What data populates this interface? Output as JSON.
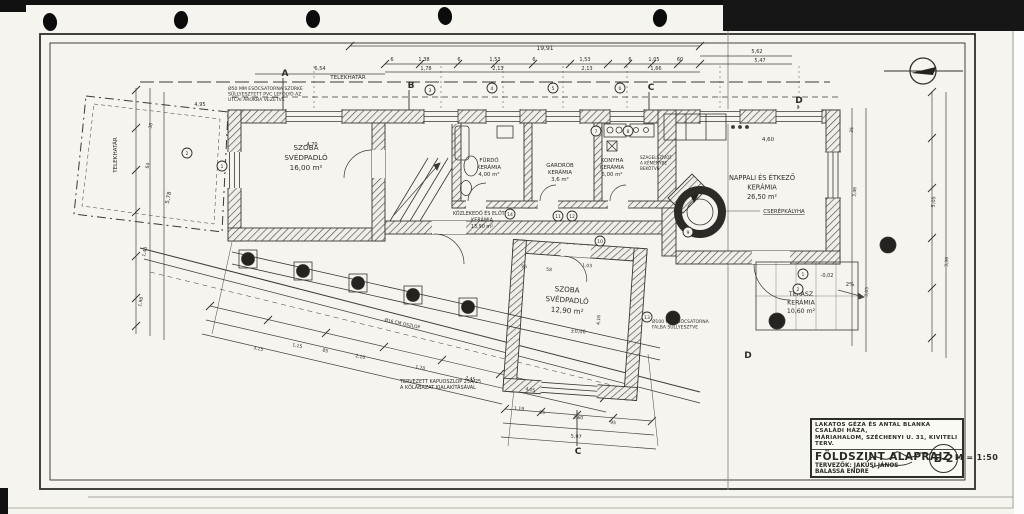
{
  "title_block": {
    "project_line1": "LAKATOS GÉZA ÉS ANTAL BLANKA CSALÁDI HÁZA,",
    "project_line2": "MÁRIAHALOM, SZÉCHENYI U. 31, KIVITELI TERV.",
    "drawing_title": "FÖLDSZINT ALAPRAJZ",
    "scale": "M = 1:50",
    "designers_label": "TERVEZŐK:",
    "designer_1": "JAKUSI JÁNOS",
    "designer_2": "BALASSA ENDRE",
    "sheet_code": "E-2"
  },
  "plan": {
    "rooms": [
      {
        "label": [
          "SZOBA",
          "SVÉDPADLÓ",
          "16,00 m²"
        ],
        "x": 306,
        "y": 150,
        "s": 7.2,
        "lh": 10,
        "r": 0
      },
      {
        "label": [
          "FÜRDŐ",
          "KERÁMIA",
          "4,00 m²"
        ],
        "x": 489,
        "y": 162,
        "s": 5.4,
        "lh": 7,
        "r": 0
      },
      {
        "label": [
          "GARDRÓB",
          "KERÁMIA",
          "3,6 m²"
        ],
        "x": 560,
        "y": 167,
        "s": 5.4,
        "lh": 7,
        "r": 0
      },
      {
        "label": [
          "KONYHA",
          "KERÁMIA",
          "6,00 m²"
        ],
        "x": 612,
        "y": 162,
        "s": 5.4,
        "lh": 7,
        "r": 0
      },
      {
        "label": [
          "NAPPALI ÉS ÉTKEZŐ",
          "KERÁMIA",
          "26,50 m²"
        ],
        "x": 762,
        "y": 180,
        "s": 6.6,
        "lh": 9.5,
        "r": 0
      },
      {
        "label": [
          "KÖZLEKEDŐ ÉS ELŐTÉR",
          "KERÁMIA",
          "13,90 m²"
        ],
        "x": 482,
        "y": 215,
        "s": 4.9,
        "lh": 6.4,
        "r": 0
      },
      {
        "label": [
          "SZOBA",
          "SVÉDPADLÓ",
          "12,90 m²"
        ],
        "x": 567,
        "y": 292,
        "s": 7.2,
        "lh": 10.5,
        "r": 4
      },
      {
        "label": [
          "TERASZ",
          "KERÁMIA",
          "10,60 m²"
        ],
        "x": 801,
        "y": 296,
        "s": 6.2,
        "lh": 8.5,
        "r": 0
      }
    ],
    "notes": [
      {
        "lines": [
          "Ø50 MM ESŐCSATORNA SZÜRKE",
          "SÜLLYESZTETT PVC LEFOLYÓ AZ",
          "UTCAI ÁROKBA VEZETVE"
        ],
        "x": 228,
        "y": 90,
        "s": 4.6,
        "lh": 5.6
      },
      {
        "lines": [
          "SZAGELSZÍVÓT",
          "A KÉMÉNYBE",
          "BEKÖTVE"
        ],
        "x": 640,
        "y": 159,
        "s": 4.2,
        "lh": 5.4
      },
      {
        "lines": [
          "TERVEZETT KAPUOSZLOP 25Á/25",
          "A KŐLÁBAZAT KIALAKÍTÁSÁVAL"
        ],
        "x": 400,
        "y": 383,
        "s": 4.9,
        "lh": 6
      },
      {
        "lines": [
          "Ø100 MM ESŐCSATORNA",
          "FALBA SÜLLYESZTVE"
        ],
        "x": 652,
        "y": 323,
        "s": 4.5,
        "lh": 5.6
      }
    ],
    "texts": [
      {
        "t": "TELEKHATÁR",
        "x": 348,
        "y": 79,
        "s": 5.6
      },
      {
        "t": "TELEKHATÁR",
        "x": 117,
        "y": 155,
        "s": 5.6,
        "r": -90
      },
      {
        "t": "CSERÉPKÁLYHA",
        "x": 784,
        "y": 213,
        "s": 5.4,
        "u": 1
      },
      {
        "t": "Ø16 CM OSZLOP",
        "x": 402,
        "y": 325,
        "s": 4.4,
        "r": 12
      },
      {
        "t": "2%",
        "x": 850,
        "y": 286,
        "s": 5.6
      },
      {
        "t": "-0,02",
        "x": 827,
        "y": 277,
        "s": 5
      },
      {
        "t": "±0,00",
        "x": 578,
        "y": 333,
        "s": 5,
        "r": 4
      }
    ],
    "dims": [
      {
        "t": "19,91",
        "x": 545,
        "y": 50,
        "s": 6
      },
      {
        "t": "6",
        "x": 392,
        "y": 61
      },
      {
        "t": "1,38",
        "x": 424,
        "y": 61
      },
      {
        "t": "1,78",
        "x": 426,
        "y": 70
      },
      {
        "t": "6",
        "x": 459,
        "y": 61
      },
      {
        "t": "1,53",
        "x": 495,
        "y": 61
      },
      {
        "t": "2,13",
        "x": 498,
        "y": 70
      },
      {
        "t": "6",
        "x": 534,
        "y": 61
      },
      {
        "t": "1,53",
        "x": 585,
        "y": 61
      },
      {
        "t": "2,13",
        "x": 587,
        "y": 70
      },
      {
        "t": "6",
        "x": 630,
        "y": 61
      },
      {
        "t": "1,05",
        "x": 654,
        "y": 61
      },
      {
        "t": "1,66",
        "x": 656,
        "y": 70
      },
      {
        "t": "60",
        "x": 680,
        "y": 61
      },
      {
        "t": "5,62",
        "x": 757,
        "y": 53
      },
      {
        "t": "5,47",
        "x": 760,
        "y": 62
      },
      {
        "t": "6,54",
        "x": 320,
        "y": 70
      },
      {
        "t": "4,95",
        "x": 200,
        "y": 106
      },
      {
        "t": "4,70",
        "x": 312,
        "y": 146
      },
      {
        "t": "4,60",
        "x": 768,
        "y": 141,
        "s": 5.5
      },
      {
        "t": "96",
        "x": 524,
        "y": 268,
        "r": 4,
        "s": 4.5
      },
      {
        "t": "58",
        "x": 549,
        "y": 271,
        "r": 4,
        "s": 4.5
      },
      {
        "t": "1,03",
        "x": 587,
        "y": 267,
        "r": 4,
        "s": 4.5
      },
      {
        "t": "4,16",
        "x": 600,
        "y": 320,
        "r": -86,
        "s": 4.5
      },
      {
        "t": "1,19",
        "x": 519,
        "y": 410,
        "r": 5,
        "s": 4.5
      },
      {
        "t": "95",
        "x": 542,
        "y": 414,
        "r": 5,
        "s": 4.5
      },
      {
        "t": "3,60",
        "x": 578,
        "y": 419,
        "r": 5,
        "s": 4.5
      },
      {
        "t": "95",
        "x": 613,
        "y": 424,
        "r": 5,
        "s": 4.5
      },
      {
        "t": "5,97",
        "x": 576,
        "y": 438,
        "r": 5,
        "s": 5
      },
      {
        "t": "3,15",
        "x": 258,
        "y": 350,
        "r": 12,
        "s": 4.5
      },
      {
        "t": "1,15",
        "x": 297,
        "y": 347,
        "r": 12,
        "s": 4.5
      },
      {
        "t": "85",
        "x": 325,
        "y": 352,
        "r": 12,
        "s": 4.5
      },
      {
        "t": "2,10",
        "x": 360,
        "y": 358,
        "r": 12,
        "s": 4.5
      },
      {
        "t": "1,70",
        "x": 420,
        "y": 369,
        "r": 12,
        "s": 4.5
      },
      {
        "t": "2,45",
        "x": 470,
        "y": 380,
        "r": 12,
        "s": 4.5
      },
      {
        "t": "4,05",
        "x": 530,
        "y": 391,
        "r": 12,
        "s": 4.5
      },
      {
        "t": "30",
        "x": 152,
        "y": 126,
        "r": -78,
        "s": 4.5
      },
      {
        "t": "64",
        "x": 149,
        "y": 166,
        "r": -78,
        "s": 4.5
      },
      {
        "t": "5,78",
        "x": 170,
        "y": 198,
        "r": -78,
        "s": 5.5
      },
      {
        "t": "1,40",
        "x": 146,
        "y": 252,
        "r": -78,
        "s": 4.5
      },
      {
        "t": "1,90",
        "x": 142,
        "y": 302,
        "r": -78,
        "s": 4.5
      },
      {
        "t": "35",
        "x": 853,
        "y": 130,
        "r": -86,
        "s": 4.5
      },
      {
        "t": "3,46",
        "x": 856,
        "y": 192,
        "r": -86,
        "s": 4.5
      },
      {
        "t": "3,05",
        "x": 868,
        "y": 292,
        "r": -86,
        "s": 4.5
      },
      {
        "t": "5,05",
        "x": 935,
        "y": 202,
        "r": -86,
        "s": 5
      },
      {
        "t": "3,36",
        "x": 948,
        "y": 262,
        "r": -86,
        "s": 4.5
      }
    ],
    "markers": [
      {
        "n": "2",
        "x": 187,
        "y": 153
      },
      {
        "n": "1",
        "x": 222,
        "y": 166
      },
      {
        "n": "3",
        "x": 430,
        "y": 90
      },
      {
        "n": "4",
        "x": 492,
        "y": 88
      },
      {
        "n": "5",
        "x": 553,
        "y": 88
      },
      {
        "n": "6",
        "x": 620,
        "y": 88
      },
      {
        "n": "7",
        "x": 596,
        "y": 131
      },
      {
        "n": "8",
        "x": 628,
        "y": 131
      },
      {
        "n": "14",
        "x": 510,
        "y": 214
      },
      {
        "n": "11",
        "x": 558,
        "y": 216
      },
      {
        "n": "12",
        "x": 572,
        "y": 216
      },
      {
        "n": "13",
        "x": 647,
        "y": 317
      },
      {
        "n": "9",
        "x": 688,
        "y": 232
      },
      {
        "n": "10",
        "x": 600,
        "y": 241
      },
      {
        "n": "1",
        "x": 803,
        "y": 274
      },
      {
        "n": "2",
        "x": 798,
        "y": 289
      }
    ],
    "sections": [
      {
        "t": "A",
        "x": 285,
        "y": 76
      },
      {
        "t": "B",
        "x": 411,
        "y": 88
      },
      {
        "t": "C",
        "x": 651,
        "y": 90
      },
      {
        "t": "D",
        "x": 799,
        "y": 103
      },
      {
        "t": "C",
        "x": 578,
        "y": 454
      },
      {
        "t": "D",
        "x": 748,
        "y": 358
      }
    ]
  }
}
